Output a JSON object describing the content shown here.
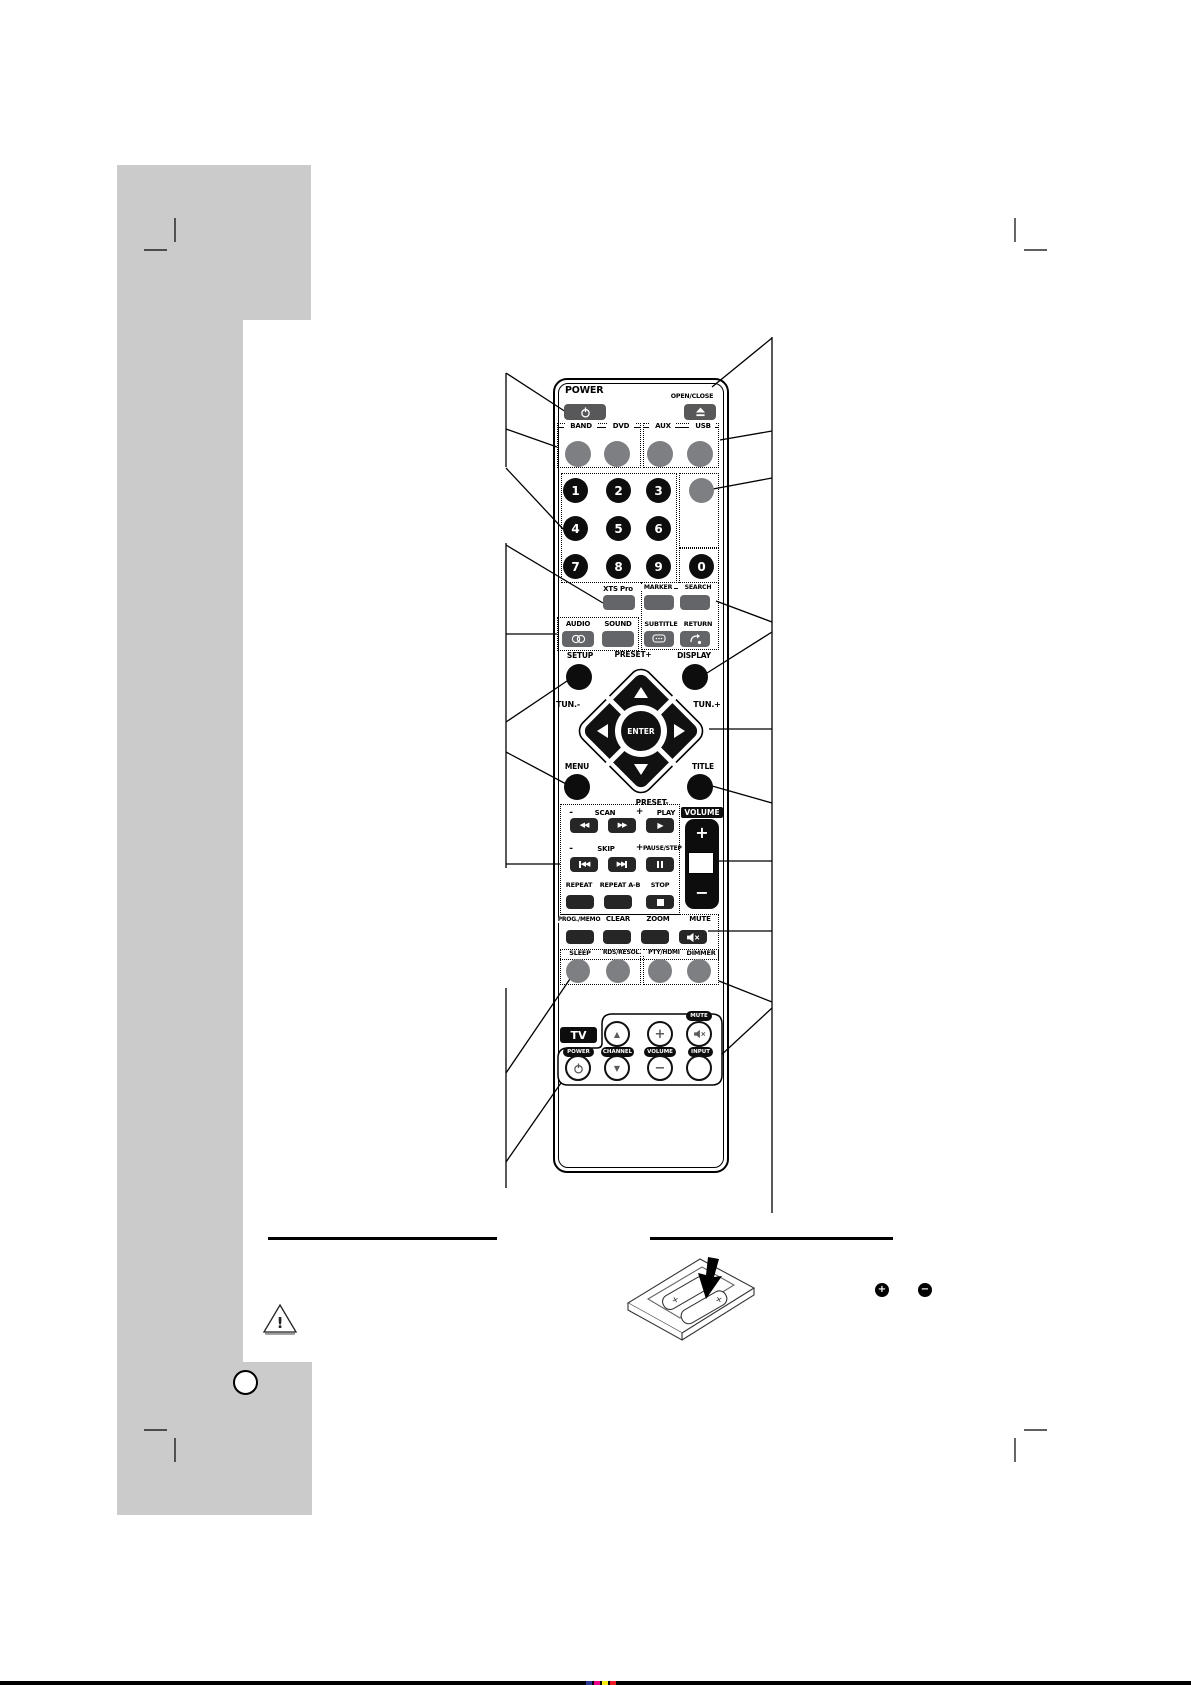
{
  "remote": {
    "power": "POWER",
    "open_close": "OPEN/CLOSE",
    "sources": [
      "BAND",
      "DVD",
      "AUX",
      "USB"
    ],
    "digits": [
      "1",
      "2",
      "3",
      "4",
      "5",
      "6",
      "7",
      "8",
      "9",
      "0"
    ],
    "xts_pro": "XTS Pro",
    "marker": "MARKER",
    "search": "SEARCH",
    "audio": "AUDIO",
    "sound": "SOUND",
    "subtitle": "SUBTITLE",
    "return": "RETURN",
    "setup": "SETUP",
    "preset_plus": "PRESET+",
    "display": "DISPLAY",
    "tun_minus": "TUN.-",
    "tun_plus": "TUN.+",
    "enter": "ENTER",
    "menu": "MENU",
    "title": "TITLE",
    "preset_minus": "PRESET-",
    "scan": {
      "minus": "-",
      "label": "SCAN",
      "plus": "+",
      "play": "PLAY"
    },
    "skip": {
      "minus": "-",
      "label": "SKIP",
      "plus": "+",
      "pause": "PAUSE/STEP"
    },
    "repeat": "REPEAT",
    "repeat_ab": "REPEAT A-B",
    "stop": "STOP",
    "prog_memo": "PROG./MEMO.",
    "clear": "CLEAR",
    "zoom": "ZOOM",
    "mute": "MUTE",
    "sleep": "SLEEP",
    "rds_resol": "RDS/RESOL.",
    "pty_hdmi": "PTY/HDMI",
    "dimmer": "DIMMER",
    "volume": "VOLUME",
    "volume_plus": "+",
    "volume_minus": "−",
    "tv": {
      "tv": "TV",
      "mute": "MUTE",
      "power": "POWER",
      "channel": "CHANNEL",
      "volume": "VOLUME",
      "input": "INPUT",
      "channel_up": "▲",
      "channel_down": "▼",
      "volume_plus": "+",
      "volume_minus": "−"
    }
  },
  "battery_section": {
    "plus": "+",
    "minus": "−",
    "battery_polarity": "+"
  },
  "warning_mark": "!",
  "icons": {
    "up": "▲",
    "down": "▼",
    "left": "◀",
    "right": "▶",
    "rew": "◀◀",
    "ff": "▶▶",
    "play": "▶"
  },
  "colors": {
    "page_gray": "#cbcbcb",
    "button_gray": "#636569",
    "round_gray": "#7d7f82",
    "button_dark": "#262626",
    "black": "#0d0d0d"
  }
}
